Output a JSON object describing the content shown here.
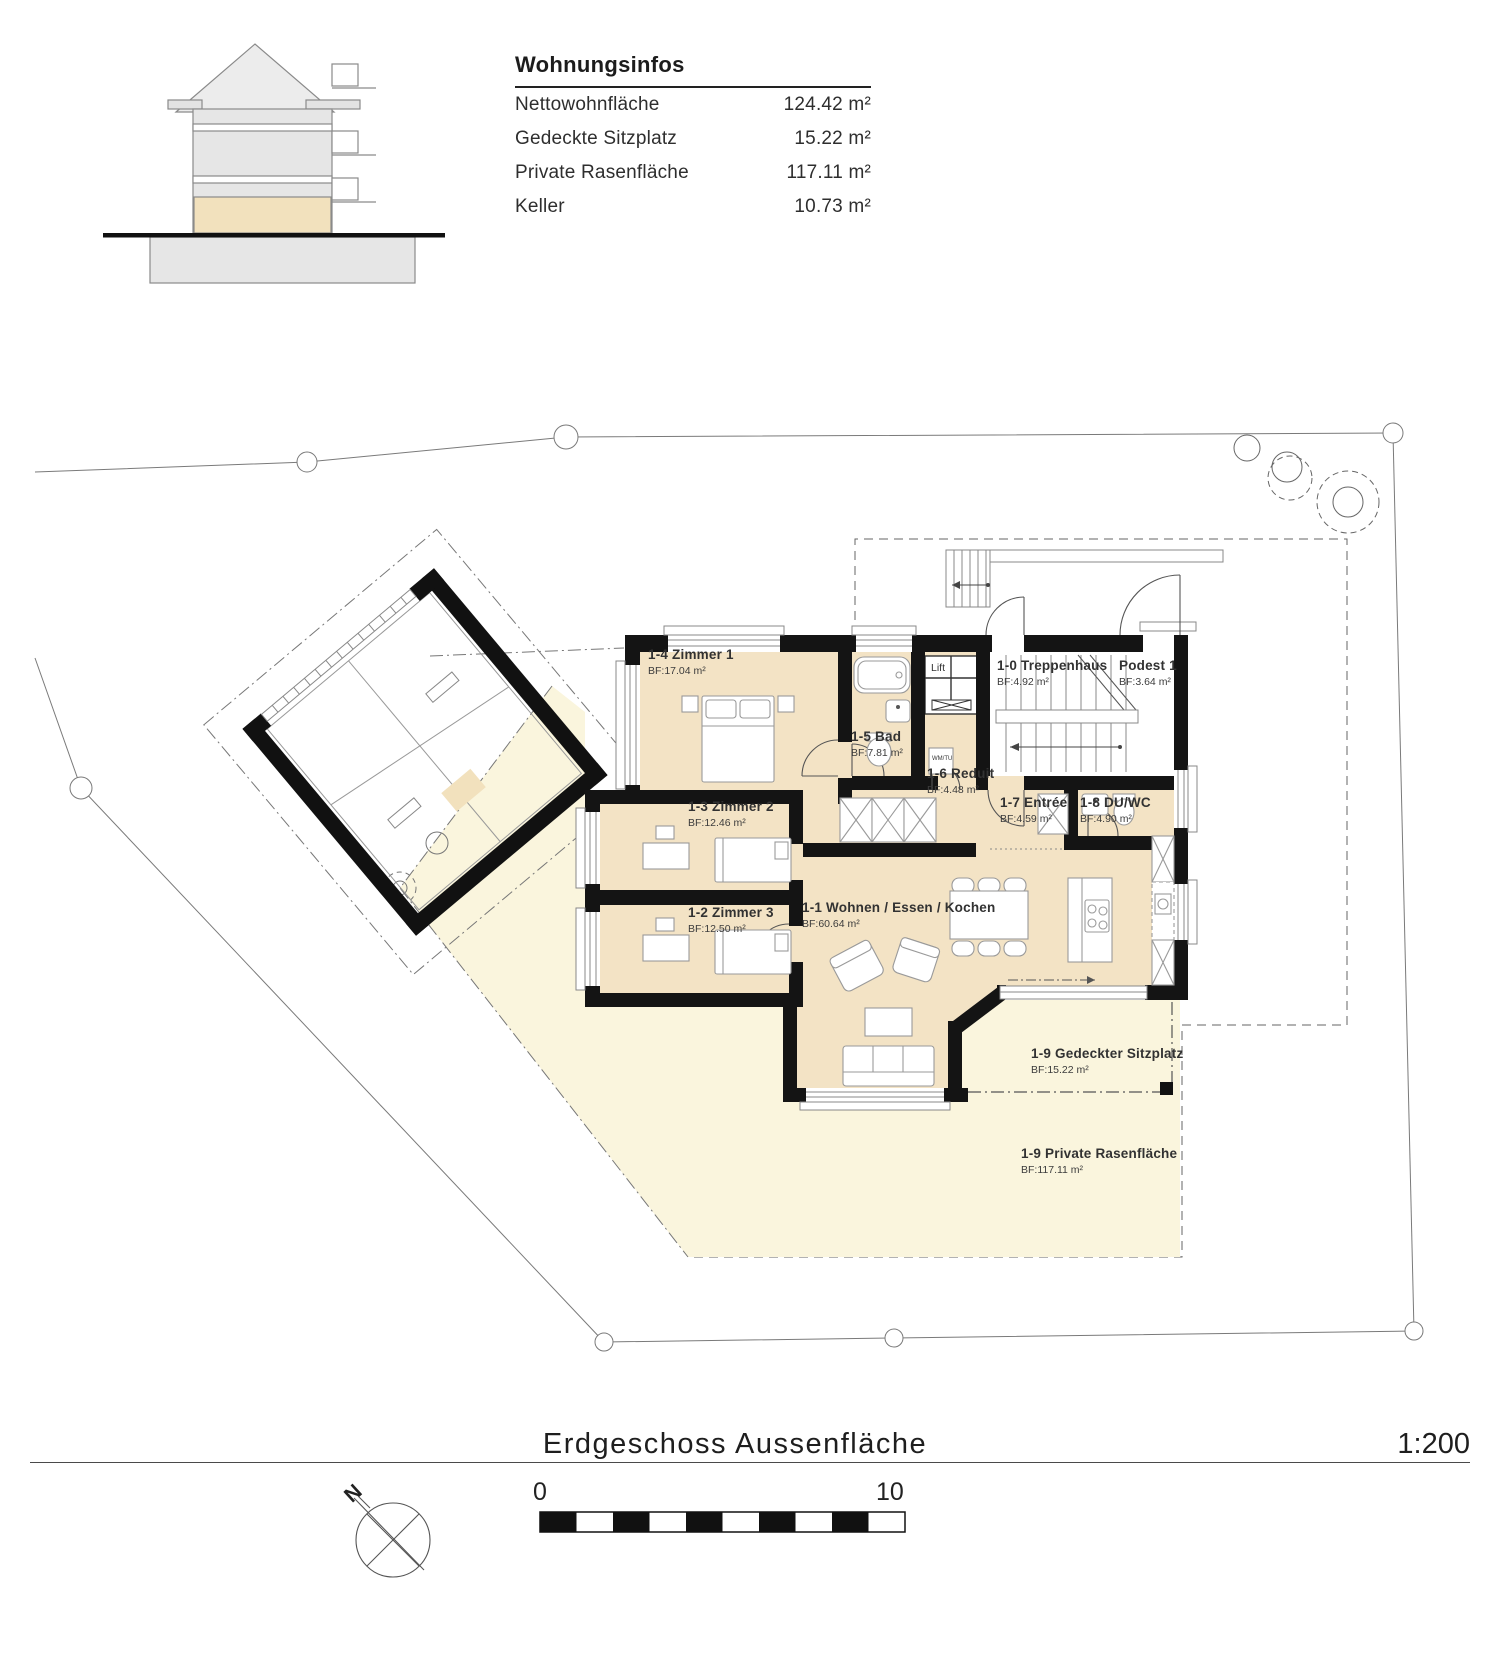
{
  "header": {
    "panel_title": "Wohnungsinfos",
    "rows": [
      {
        "label": "Nettowohnfläche",
        "value": "124.42 m²"
      },
      {
        "label": "Gedeckte Sitzplatz",
        "value": "15.22 m²"
      },
      {
        "label": "Private Rasenfläche",
        "value": "117.11 m²"
      },
      {
        "label": "Keller",
        "value": "10.73 m²"
      }
    ]
  },
  "rooms": [
    {
      "name": "1-4 Zimmer 1",
      "area": "BF:17.04 m²"
    },
    {
      "name": "1-5 Bad",
      "area": "BF:7.81 m²"
    },
    {
      "name": "1-6 Reduit",
      "area": "BF:4.48 m²"
    },
    {
      "name": "1-0 Treppenhaus",
      "area": "BF:4.92 m²"
    },
    {
      "name": "Podest 1",
      "area": "BF:3.64 m²"
    },
    {
      "name": "1-3 Zimmer 2",
      "area": "BF:12.46 m²"
    },
    {
      "name": "1-7 Entrée",
      "area": "BF:4.59 m²"
    },
    {
      "name": "1-8 DU/WC",
      "area": "BF:4.90 m²"
    },
    {
      "name": "1-2 Zimmer 3",
      "area": "BF:12.50 m²"
    },
    {
      "name": "1-1 Wohnen / Essen / Kochen",
      "area": "BF:60.64 m²"
    },
    {
      "name": "1-9 Gedeckter Sitzplatz",
      "area": "BF:15.22 m²"
    },
    {
      "name": "1-9 Private Rasenfläche",
      "area": "BF:117.11 m²"
    }
  ],
  "plan_labels": {
    "lift": "Lift",
    "washer": "WM/TU"
  },
  "footer": {
    "drawing_title": "Erdgeschoss Aussenfläche",
    "scale": "1:200",
    "north": "N",
    "scalebar_start": "0",
    "scalebar_end": "10"
  },
  "colors": {
    "room_fill": "#f3e3c5",
    "lawn_fill": "#faf5dd",
    "wall": "#141414",
    "section_floor_highlight": "#f2e1bd"
  }
}
